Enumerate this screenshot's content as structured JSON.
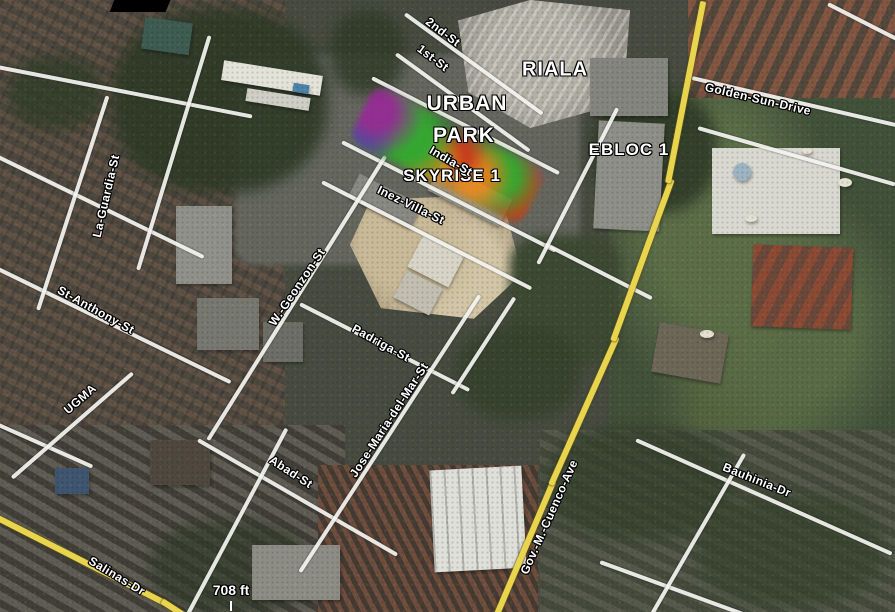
{
  "poi_labels": {
    "riala": "RIALA",
    "urban_park_line1": "URBAN",
    "urban_park_line2": "PARK",
    "ebloc1": "EBLOC 1",
    "skyrise1": "SKYRISE 1"
  },
  "street_labels": {
    "second_st": "2nd-St",
    "first_st": "1st-St",
    "india_st": "India-St",
    "inez_villa_st": "Inez-Villa-St",
    "golden_sun_drive": "Golden-Sun-Drive",
    "la_guardia_st": "La-Guardia-St",
    "st_anthony_st": "St-Anthony-St",
    "ugma": "UGMA",
    "w_geonzon_st": "W.-Geonzon-St",
    "padriga_st": "Padriga-St",
    "jose_maria_del_mar_st": "Jose-Maria-del-Mar-St",
    "abad_st": "Abad-St",
    "salinas_dr": "Salinas-Dr",
    "gov_m_cuenco_ave": "Gov.-M.-Cuenco-Ave",
    "bauhinia_dr": "Bauhinia-Dr"
  },
  "scale_bar": {
    "distance": "708 ft"
  },
  "colors": {
    "road_major": "#e9d44e",
    "road_minor": "#f4f4f0",
    "label_text": "#ffffff",
    "heat_green": "#3fae3c",
    "heat_orange": "#e08a2a",
    "heat_red": "#c0391d",
    "heat_purple": "#8c2a8c",
    "heat_blue": "#2a5a9a"
  }
}
